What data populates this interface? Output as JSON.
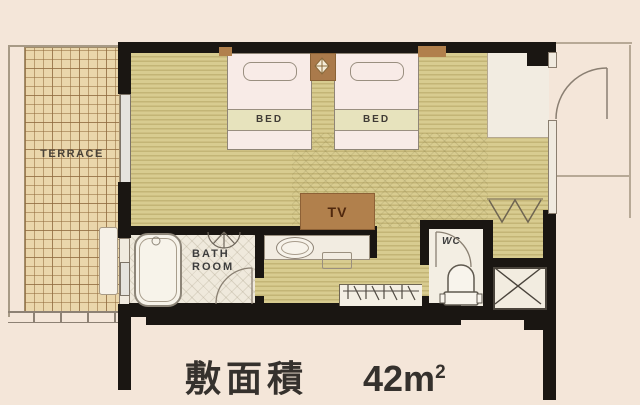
{
  "plan": {
    "terrace": {
      "label": "TERRACE"
    },
    "beds": {
      "bed1_label": "BED",
      "bed2_label": "BED"
    },
    "tv": {
      "label": "TV"
    },
    "bathroom": {
      "label_line1": "BATH",
      "label_line2": "ROOM"
    },
    "wc": {
      "label": "WC"
    },
    "caption": {
      "label": "敷面積",
      "value": "42m",
      "superscript": "2"
    },
    "colors": {
      "background": "#f4e6d9",
      "wall": "#1a1612",
      "wood_floor": "#d8cc90",
      "wood_floor_stripe": "#c3b576",
      "terrace_tile": "#ead6ab",
      "furniture_brown": "#b1804c",
      "bed_linen": "#f8ebe7",
      "bed_band": "#e7e3bd",
      "room_white": "#f2ece1",
      "line_gray": "#8a7f70",
      "text_dark": "#3c3c3c"
    }
  }
}
